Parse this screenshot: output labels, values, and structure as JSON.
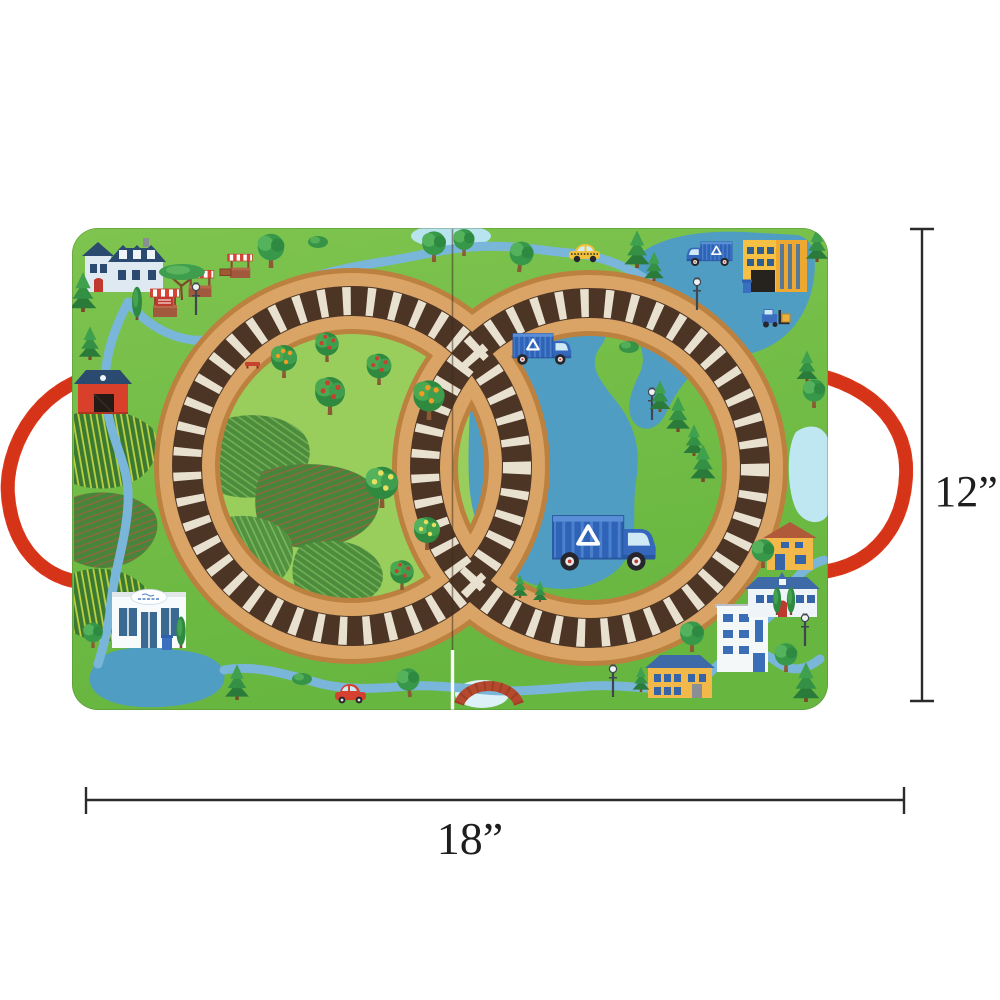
{
  "annotation": {
    "height_label": "12”",
    "width_label": "18”"
  },
  "colors": {
    "background": "#ffffff",
    "grass_green": "#6fbc45",
    "meadow_light_green": "#99ce5d",
    "lake_blue": "#4f9dc2",
    "river_blue": "#79b6da",
    "track_cork_tan": "#daa466",
    "track_tie_dark_brown": "#4d3526",
    "track_tie_cream": "#e9e1cf",
    "handle_red": "#e43a1e",
    "dimension_line_black": "#2b2b2b"
  },
  "scene": {
    "description": "Fold-out toy train play board with double-loop railroad track, farm and town illustrations, lake with recycling trucks, and red rope carry handles",
    "panel_count": 2,
    "landmarks": [
      "farmhouse",
      "market-stalls",
      "barn",
      "crop-fields",
      "orchard",
      "grocery-market",
      "ponds",
      "lake",
      "recycling-trucks",
      "recycling-factory",
      "forklift",
      "taxi",
      "red-car",
      "bridge",
      "town-houses",
      "apartment-building",
      "street-lamps",
      "pine-trees",
      "rope-handles"
    ]
  }
}
